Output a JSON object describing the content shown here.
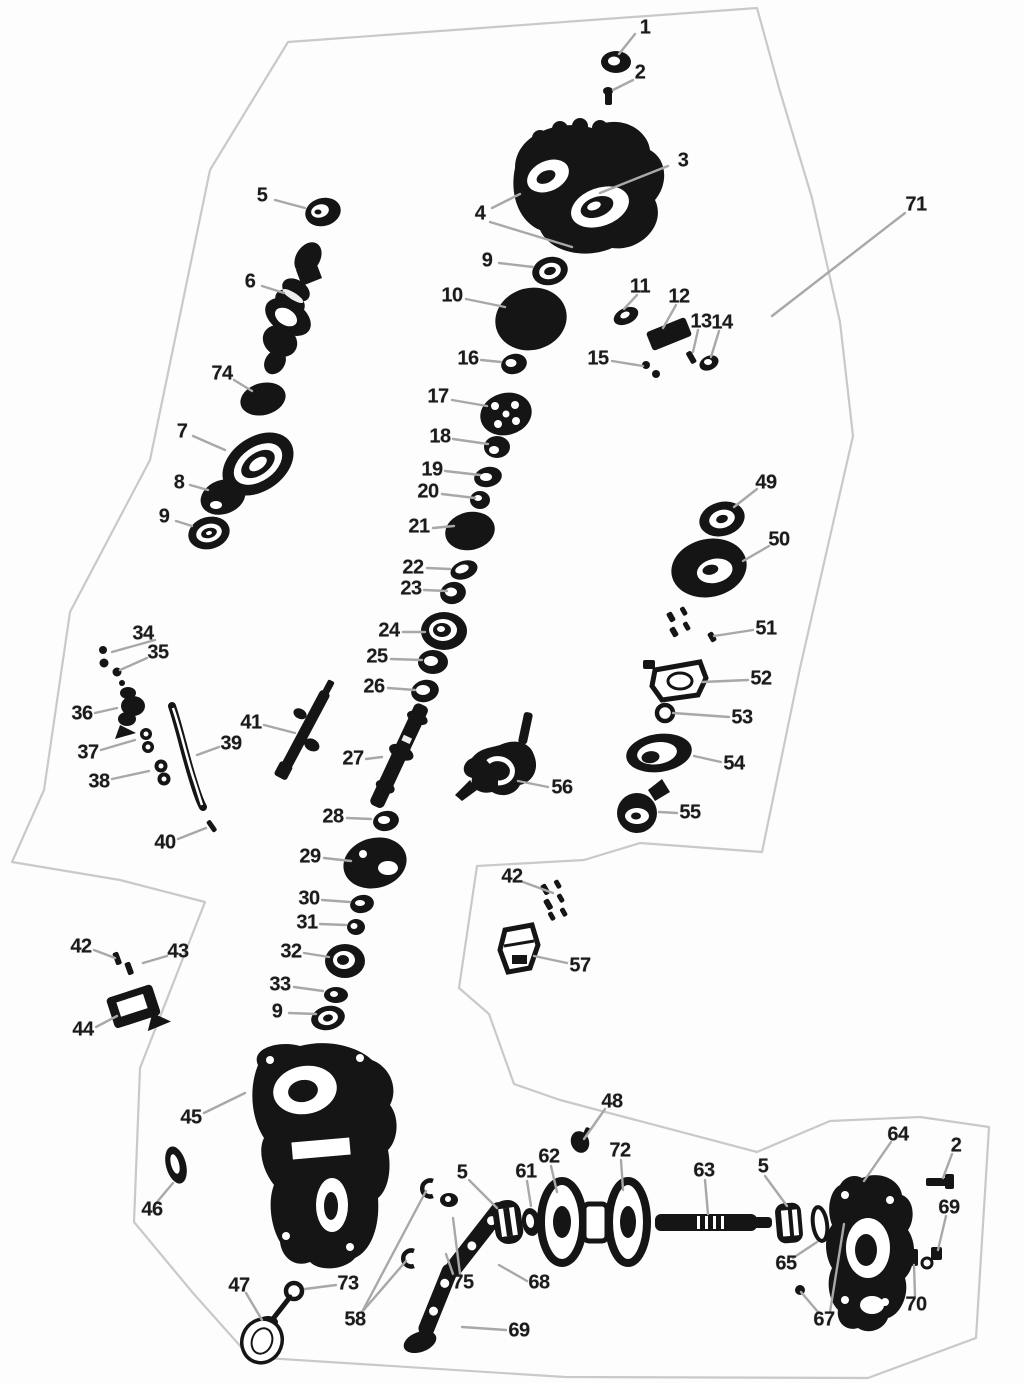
{
  "figure": {
    "kind": "exploded-parts-diagram",
    "description": "Black-and-white exploded view of a gearbox / transfer case assembly with numbered part callouts and gray leader lines inside a faint irregular border.",
    "canvas": {
      "width": 1024,
      "height": 1383
    }
  },
  "colors": {
    "background": "#fdfdfd",
    "label": "#1b1b1b",
    "leader": "#a8a8a8",
    "outline": "#c9c9c9",
    "part": "#151515"
  },
  "callouts": [
    {
      "label": "1",
      "x": 645,
      "y": 28,
      "leaders": [
        [
          635,
          34,
          619,
          54
        ]
      ]
    },
    {
      "label": "2",
      "x": 640,
      "y": 73,
      "leaders": [
        [
          633,
          80,
          613,
          90
        ]
      ]
    },
    {
      "label": "3",
      "x": 683,
      "y": 161,
      "leaders": [
        [
          668,
          166,
          600,
          193
        ]
      ]
    },
    {
      "label": "4",
      "x": 480,
      "y": 214,
      "leaders": [
        [
          492,
          208,
          520,
          194
        ],
        [
          490,
          222,
          572,
          247
        ]
      ]
    },
    {
      "label": "5",
      "x": 262,
      "y": 196,
      "leaders": [
        [
          275,
          200,
          305,
          208
        ]
      ]
    },
    {
      "label": "6",
      "x": 250,
      "y": 282,
      "leaders": [
        [
          262,
          286,
          284,
          293
        ]
      ]
    },
    {
      "label": "74",
      "x": 222,
      "y": 374,
      "leaders": [
        [
          234,
          380,
          252,
          391
        ]
      ]
    },
    {
      "label": "7",
      "x": 182,
      "y": 432,
      "leaders": [
        [
          193,
          436,
          225,
          450
        ]
      ]
    },
    {
      "label": "8",
      "x": 179,
      "y": 483,
      "leaders": [
        [
          190,
          485,
          208,
          490
        ]
      ]
    },
    {
      "label": "9",
      "x": 164,
      "y": 517,
      "leaders": [
        [
          176,
          521,
          192,
          526
        ]
      ]
    },
    {
      "label": "9",
      "x": 487,
      "y": 261,
      "leaders": [
        [
          499,
          263,
          533,
          267
        ]
      ]
    },
    {
      "label": "10",
      "x": 452,
      "y": 296,
      "leaders": [
        [
          466,
          299,
          505,
          307
        ]
      ]
    },
    {
      "label": "11",
      "x": 640,
      "y": 287,
      "leaders": [
        [
          637,
          295,
          624,
          309
        ]
      ]
    },
    {
      "label": "12",
      "x": 679,
      "y": 297,
      "leaders": [
        [
          676,
          305,
          663,
          328
        ]
      ]
    },
    {
      "label": "13",
      "x": 701,
      "y": 322,
      "leaders": [
        [
          698,
          330,
          693,
          352
        ]
      ]
    },
    {
      "label": "14",
      "x": 722,
      "y": 323,
      "leaders": [
        [
          719,
          331,
          711,
          357
        ]
      ]
    },
    {
      "label": "15",
      "x": 598,
      "y": 359,
      "leaders": [
        [
          612,
          361,
          643,
          366
        ]
      ]
    },
    {
      "label": "16",
      "x": 468,
      "y": 359,
      "leaders": [
        [
          481,
          360,
          501,
          362
        ]
      ]
    },
    {
      "label": "17",
      "x": 438,
      "y": 397,
      "leaders": [
        [
          452,
          400,
          487,
          406
        ]
      ]
    },
    {
      "label": "18",
      "x": 440,
      "y": 437,
      "leaders": [
        [
          453,
          439,
          488,
          444
        ]
      ]
    },
    {
      "label": "19",
      "x": 432,
      "y": 470,
      "leaders": [
        [
          445,
          471,
          480,
          475
        ]
      ]
    },
    {
      "label": "20",
      "x": 428,
      "y": 492,
      "leaders": [
        [
          442,
          494,
          475,
          498
        ]
      ]
    },
    {
      "label": "21",
      "x": 419,
      "y": 527,
      "leaders": [
        [
          433,
          528,
          454,
          526
        ]
      ]
    },
    {
      "label": "22",
      "x": 413,
      "y": 568,
      "leaders": [
        [
          427,
          568,
          450,
          569
        ]
      ]
    },
    {
      "label": "23",
      "x": 411,
      "y": 589,
      "leaders": [
        [
          424,
          590,
          447,
          591
        ]
      ]
    },
    {
      "label": "24",
      "x": 389,
      "y": 631,
      "leaders": [
        [
          403,
          632,
          425,
          632
        ]
      ]
    },
    {
      "label": "25",
      "x": 377,
      "y": 657,
      "leaders": [
        [
          391,
          659,
          422,
          660
        ]
      ]
    },
    {
      "label": "26",
      "x": 374,
      "y": 687,
      "leaders": [
        [
          388,
          688,
          415,
          690
        ]
      ]
    },
    {
      "label": "27",
      "x": 353,
      "y": 759,
      "leaders": [
        [
          366,
          759,
          382,
          757
        ]
      ]
    },
    {
      "label": "28",
      "x": 333,
      "y": 817,
      "leaders": [
        [
          347,
          818,
          371,
          819
        ]
      ]
    },
    {
      "label": "29",
      "x": 310,
      "y": 857,
      "leaders": [
        [
          324,
          858,
          351,
          861
        ]
      ]
    },
    {
      "label": "30",
      "x": 309,
      "y": 899,
      "leaders": [
        [
          322,
          900,
          350,
          902
        ]
      ]
    },
    {
      "label": "31",
      "x": 307,
      "y": 923,
      "leaders": [
        [
          320,
          924,
          346,
          925
        ]
      ]
    },
    {
      "label": "32",
      "x": 291,
      "y": 952,
      "leaders": [
        [
          304,
          953,
          329,
          957
        ]
      ]
    },
    {
      "label": "33",
      "x": 280,
      "y": 985,
      "leaders": [
        [
          294,
          987,
          323,
          991
        ]
      ]
    },
    {
      "label": "9",
      "x": 277,
      "y": 1012,
      "leaders": [
        [
          289,
          1013,
          316,
          1014
        ]
      ]
    },
    {
      "label": "34",
      "x": 143,
      "y": 634,
      "leaders": [
        [
          155,
          640,
          112,
          652
        ]
      ]
    },
    {
      "label": "35",
      "x": 158,
      "y": 653,
      "leaders": [
        [
          147,
          658,
          120,
          670
        ]
      ]
    },
    {
      "label": "36",
      "x": 82,
      "y": 714,
      "leaders": [
        [
          95,
          713,
          117,
          708
        ]
      ]
    },
    {
      "label": "37",
      "x": 88,
      "y": 753,
      "leaders": [
        [
          101,
          750,
          135,
          740
        ]
      ]
    },
    {
      "label": "38",
      "x": 99,
      "y": 782,
      "leaders": [
        [
          112,
          779,
          149,
          771
        ]
      ]
    },
    {
      "label": "39",
      "x": 231,
      "y": 744,
      "leaders": [
        [
          219,
          747,
          197,
          755
        ]
      ]
    },
    {
      "label": "40",
      "x": 165,
      "y": 843,
      "leaders": [
        [
          178,
          839,
          206,
          828
        ]
      ]
    },
    {
      "label": "41",
      "x": 251,
      "y": 723,
      "leaders": [
        [
          264,
          725,
          295,
          733
        ]
      ]
    },
    {
      "label": "42",
      "x": 81,
      "y": 947,
      "leaders": [
        [
          94,
          950,
          115,
          958
        ]
      ]
    },
    {
      "label": "43",
      "x": 178,
      "y": 952,
      "leaders": [
        [
          167,
          956,
          143,
          963
        ]
      ]
    },
    {
      "label": "44",
      "x": 83,
      "y": 1030,
      "leaders": [
        [
          96,
          1027,
          117,
          1016
        ]
      ]
    },
    {
      "label": "45",
      "x": 191,
      "y": 1118,
      "leaders": [
        [
          204,
          1113,
          245,
          1093
        ]
      ]
    },
    {
      "label": "46",
      "x": 152,
      "y": 1210,
      "leaders": [
        [
          157,
          1202,
          173,
          1183
        ]
      ]
    },
    {
      "label": "47",
      "x": 239,
      "y": 1286,
      "leaders": [
        [
          246,
          1293,
          262,
          1320
        ]
      ]
    },
    {
      "label": "73",
      "x": 348,
      "y": 1284,
      "leaders": [
        [
          336,
          1285,
          305,
          1289
        ]
      ]
    },
    {
      "label": "58",
      "x": 355,
      "y": 1320,
      "leaders": [
        [
          362,
          1312,
          406,
          1261
        ],
        [
          362,
          1312,
          426,
          1191
        ]
      ]
    },
    {
      "label": "75",
      "x": 463,
      "y": 1283,
      "leaders": [
        [
          453,
          1274,
          446,
          1254
        ],
        [
          460,
          1274,
          453,
          1218
        ]
      ]
    },
    {
      "label": "68",
      "x": 539,
      "y": 1283,
      "leaders": [
        [
          527,
          1281,
          499,
          1265
        ]
      ]
    },
    {
      "label": "69",
      "x": 519,
      "y": 1331,
      "leaders": [
        [
          506,
          1330,
          462,
          1327
        ]
      ]
    },
    {
      "label": "48",
      "x": 612,
      "y": 1102,
      "leaders": [
        [
          605,
          1109,
          584,
          1139
        ]
      ]
    },
    {
      "label": "5",
      "x": 462,
      "y": 1173,
      "leaders": [
        [
          469,
          1180,
          497,
          1208
        ]
      ]
    },
    {
      "label": "61",
      "x": 526,
      "y": 1172,
      "leaders": [
        [
          527,
          1181,
          531,
          1206
        ]
      ]
    },
    {
      "label": "62",
      "x": 549,
      "y": 1157,
      "leaders": [
        [
          551,
          1166,
          557,
          1192
        ]
      ]
    },
    {
      "label": "72",
      "x": 620,
      "y": 1151,
      "leaders": [
        [
          621,
          1160,
          623,
          1190
        ]
      ]
    },
    {
      "label": "63",
      "x": 704,
      "y": 1171,
      "leaders": [
        [
          705,
          1180,
          708,
          1214
        ]
      ]
    },
    {
      "label": "5",
      "x": 763,
      "y": 1167,
      "leaders": [
        [
          765,
          1176,
          787,
          1206
        ]
      ]
    },
    {
      "label": "65",
      "x": 786,
      "y": 1264,
      "leaders": [
        [
          793,
          1258,
          817,
          1242
        ]
      ]
    },
    {
      "label": "67",
      "x": 824,
      "y": 1320,
      "leaders": [
        [
          818,
          1312,
          801,
          1292
        ],
        [
          830,
          1312,
          844,
          1224
        ]
      ]
    },
    {
      "label": "64",
      "x": 898,
      "y": 1135,
      "leaders": [
        [
          891,
          1142,
          864,
          1181
        ]
      ]
    },
    {
      "label": "2",
      "x": 956,
      "y": 1146,
      "leaders": [
        [
          952,
          1154,
          943,
          1178
        ]
      ]
    },
    {
      "label": "69",
      "x": 949,
      "y": 1208,
      "leaders": [
        [
          946,
          1216,
          938,
          1250
        ]
      ]
    },
    {
      "label": "70",
      "x": 916,
      "y": 1305,
      "leaders": [
        [
          915,
          1296,
          914,
          1265
        ]
      ]
    },
    {
      "label": "71",
      "x": 916,
      "y": 205,
      "leaders": [
        [
          905,
          213,
          772,
          316
        ]
      ]
    },
    {
      "label": "49",
      "x": 766,
      "y": 483,
      "leaders": [
        [
          757,
          489,
          734,
          507
        ]
      ]
    },
    {
      "label": "50",
      "x": 779,
      "y": 540,
      "leaders": [
        [
          769,
          546,
          743,
          561
        ]
      ]
    },
    {
      "label": "51",
      "x": 766,
      "y": 629,
      "leaders": [
        [
          753,
          630,
          714,
          636
        ]
      ]
    },
    {
      "label": "52",
      "x": 761,
      "y": 679,
      "leaders": [
        [
          748,
          680,
          702,
          682
        ]
      ]
    },
    {
      "label": "53",
      "x": 742,
      "y": 718,
      "leaders": [
        [
          729,
          717,
          673,
          713
        ]
      ]
    },
    {
      "label": "54",
      "x": 734,
      "y": 764,
      "leaders": [
        [
          721,
          762,
          694,
          756
        ]
      ]
    },
    {
      "label": "55",
      "x": 690,
      "y": 813,
      "leaders": [
        [
          677,
          813,
          659,
          812
        ]
      ]
    },
    {
      "label": "56",
      "x": 562,
      "y": 788,
      "leaders": [
        [
          548,
          787,
          518,
          781
        ]
      ]
    },
    {
      "label": "42",
      "x": 512,
      "y": 877,
      "leaders": [
        [
          523,
          882,
          553,
          893
        ]
      ]
    },
    {
      "label": "57",
      "x": 580,
      "y": 966,
      "leaders": [
        [
          567,
          963,
          534,
          956
        ]
      ]
    }
  ]
}
